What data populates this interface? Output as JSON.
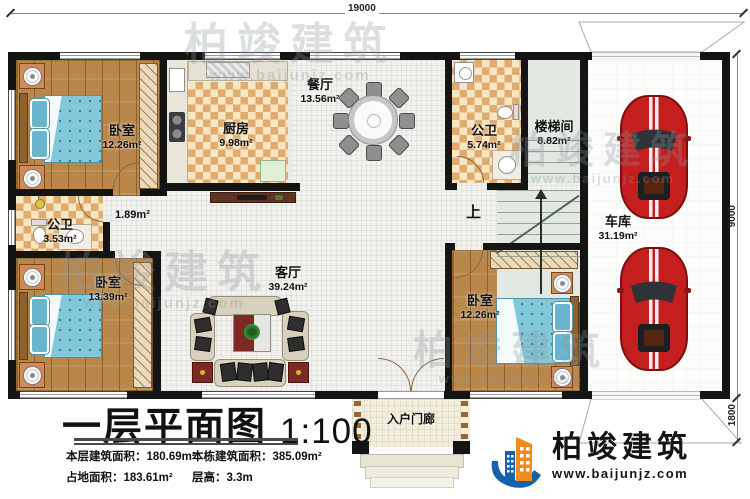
{
  "dimensions": {
    "top": "19000",
    "right_main": "9000",
    "right_lower": "1800"
  },
  "rooms": {
    "bedroom1": {
      "name": "卧室",
      "area": "12.26m²"
    },
    "kitchen": {
      "name": "厨房",
      "area": "9.98m²"
    },
    "dining": {
      "name": "餐厅",
      "area": "13.56m²"
    },
    "bath1": {
      "name": "公卫",
      "area": "3.53m²"
    },
    "hall": {
      "area": "1.89m²"
    },
    "bath2": {
      "name": "公卫",
      "area": "5.74m²"
    },
    "stairwell": {
      "name": "楼梯间",
      "area": "8.82m²"
    },
    "garage": {
      "name": "车库",
      "area": "31.19m²"
    },
    "bedroom2": {
      "name": "卧室",
      "area": "13.39m²"
    },
    "living": {
      "name": "客厅",
      "area": "39.24m²"
    },
    "bedroom3": {
      "name": "卧室",
      "area": "12.26m²"
    },
    "porch": {
      "name": "入户门廊"
    }
  },
  "stairs": {
    "up_label": "上"
  },
  "titleblock": {
    "title": "一层平面图",
    "scale": "1:100",
    "stats": [
      {
        "label": "本层建筑面积：",
        "value": "180.69m²"
      },
      {
        "label": "本栋建筑面积：",
        "value": "385.09m²"
      },
      {
        "label": "占地面积：",
        "value": "183.61m²"
      },
      {
        "label": "层高：",
        "value": "3.3m"
      }
    ]
  },
  "brand": {
    "name": "柏竣建筑",
    "website": "www.baijunjz.com"
  },
  "colors": {
    "wall": "#141414",
    "wood_floor": "#b9874a",
    "tile_check_dark": "#e0ab6d",
    "tile_check_light": "#f7e6c2",
    "bed": "#82c8da",
    "car": "#c41e1e",
    "stair_floor": "#e2e8e2",
    "brand_blue": "#1761ad",
    "brand_orange": "#f08c1e"
  }
}
